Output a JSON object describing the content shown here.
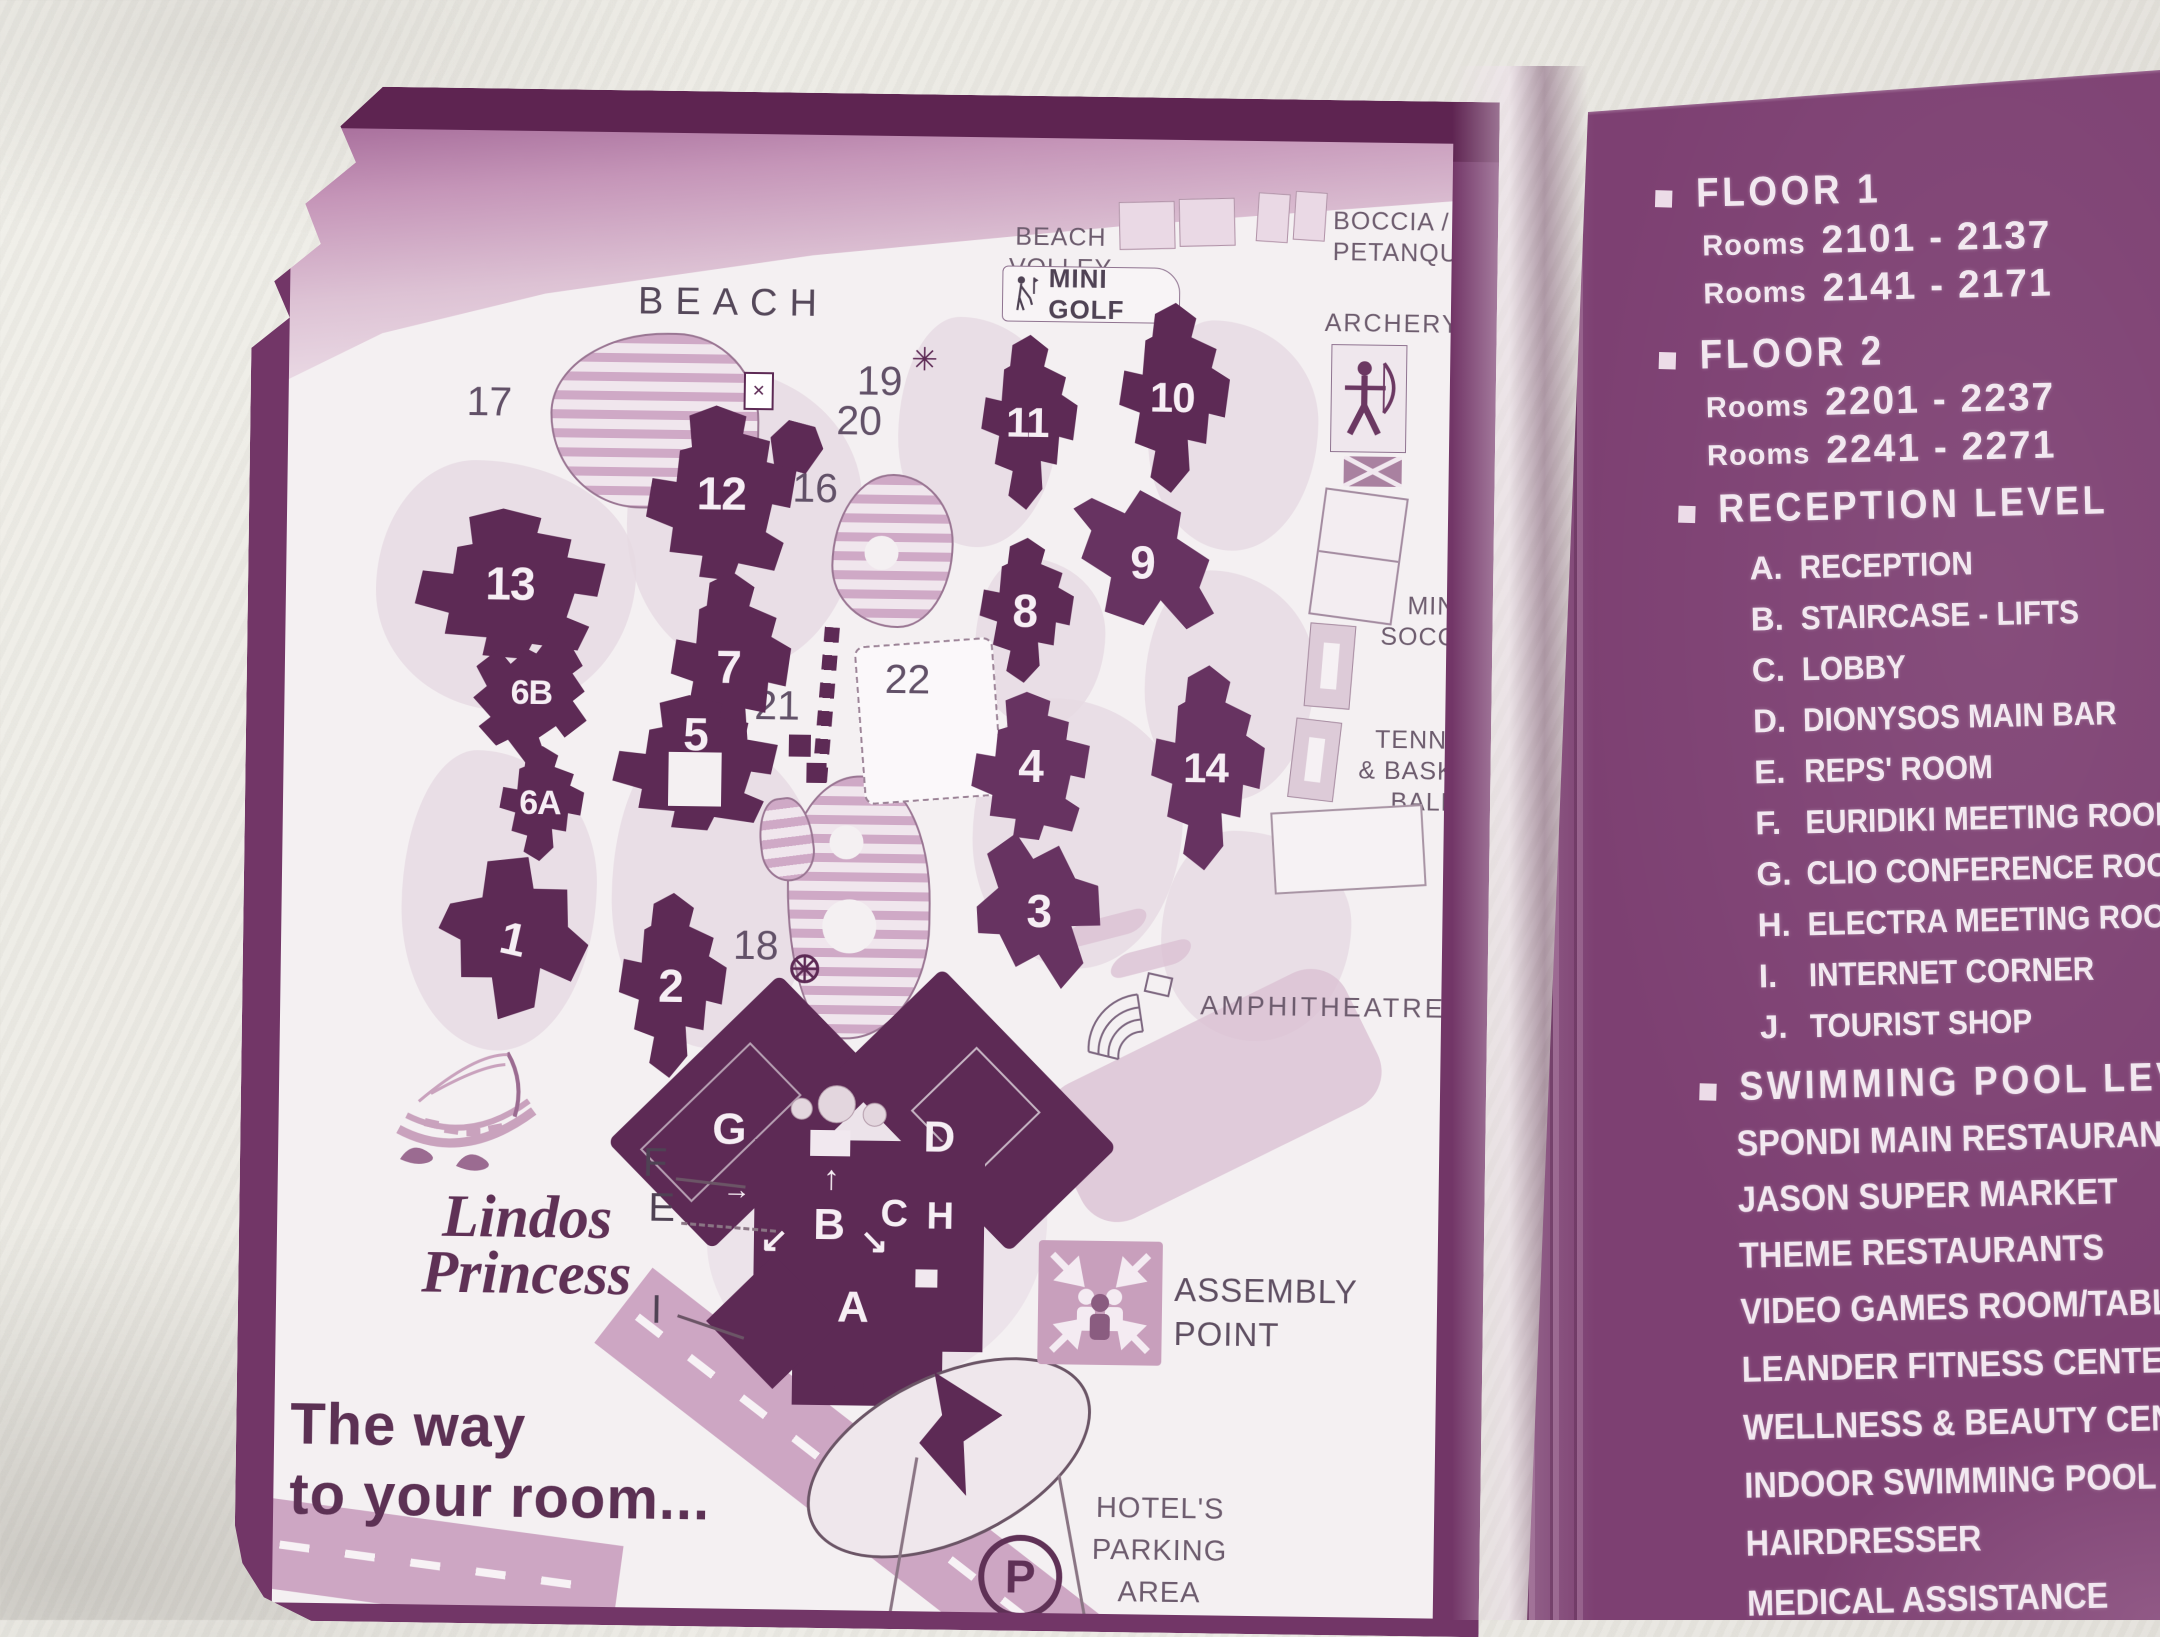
{
  "brand": {
    "name_line1": "Lindos",
    "name_line2": "Princess",
    "tagline_line1": "The way",
    "tagline_line2": "to your room..."
  },
  "map": {
    "beach": "BEACH",
    "beach_volleyball_line1": "BEACH",
    "beach_volleyball_line2": "VOLLEY BALL",
    "mini_golf": "MINI GOLF",
    "boccia_line1": "BOCCIA /",
    "boccia_line2": "PETANQUE",
    "archery": "ARCHERY",
    "mini_soccer_line1": "MINI",
    "mini_soccer_line2": "SOCCER",
    "tennis_line1": "TENNIS",
    "tennis_line2": "& BASKET",
    "tennis_line3": "BALL",
    "amphitheatre": "AMPHITHEATRE",
    "assembly_line1": "ASSEMBLY",
    "assembly_line2": "POINT",
    "parking_line1": "HOTEL'S",
    "parking_line2": "PARKING",
    "parking_line3": "AREA",
    "parking_symbol": "P",
    "cross_mark": "✕",
    "star_mark": "✳",
    "buildings": {
      "b1": "1",
      "b2": "2",
      "b3": "3",
      "b4": "4",
      "b5": "5",
      "b6a": "6A",
      "b6b": "6B",
      "b7": "7",
      "b8": "8",
      "b9": "9",
      "b10": "10",
      "b11": "11",
      "b12": "12",
      "b13": "13",
      "b14": "14"
    },
    "areas": {
      "a15": "15",
      "a16": "16",
      "a17": "17",
      "a18": "18",
      "a19": "19",
      "a20": "20",
      "a21": "21",
      "a22": "22"
    },
    "letters": {
      "A": "A",
      "B": "B",
      "C": "C",
      "D": "D",
      "E": "E",
      "F": "F",
      "G": "G",
      "H": "H",
      "I": "I",
      "J": "J"
    },
    "arrows": {
      "up": "↑",
      "down_left": "↙",
      "down_right": "↘",
      "right": "→"
    }
  },
  "panel": {
    "floor1_title": "FLOOR 1",
    "floor1_rooms": [
      {
        "word": "Rooms",
        "range": "2101 - 2137"
      },
      {
        "word": "Rooms",
        "range": "2141 - 2171"
      }
    ],
    "floor2_title": "FLOOR 2",
    "floor2_rooms": [
      {
        "word": "Rooms",
        "range": "2201 - 2237"
      },
      {
        "word": "Rooms",
        "range": "2241 - 2271"
      }
    ],
    "reception_title": "RECEPTION LEVEL",
    "reception_items": [
      {
        "key": "A.",
        "label": "RECEPTION"
      },
      {
        "key": "B.",
        "label": "STAIRCASE - LIFTS"
      },
      {
        "key": "C.",
        "label": "LOBBY"
      },
      {
        "key": "D.",
        "label": "DIONYSOS MAIN BAR"
      },
      {
        "key": "E.",
        "label": "REPS' ROOM"
      },
      {
        "key": "F.",
        "label": "EURIDIKI MEETING ROOM"
      },
      {
        "key": "G.",
        "label": "CLIO CONFERENCE ROOM"
      },
      {
        "key": "H.",
        "label": "ELECTRA MEETING ROOM"
      },
      {
        "key": "I.",
        "label": "INTERNET CORNER"
      },
      {
        "key": "J.",
        "label": "TOURIST SHOP"
      }
    ],
    "pool_title": "SWIMMING POOL LEVEL",
    "pool_items": [
      "SPONDI MAIN RESTAURANT",
      "JASON SUPER MARKET",
      "THEME RESTAURANTS",
      "VIDEO GAMES ROOM/TABLE TENNIS",
      "LEANDER FITNESS CENTER",
      "WELLNESS & BEAUTY CENTER",
      "INDOOR SWIMMING POOL",
      "HAIRDRESSER",
      "MEDICAL ASSISTANCE"
    ]
  },
  "colors": {
    "card_border": "#723667",
    "page": "#f4f0f2",
    "building": "#5d2a55",
    "panel": "#7d4072",
    "road": "#cda6c3",
    "beach_band": "#b97fa9",
    "panel_text": "#f2e8f0",
    "map_text": "#5b4a5e"
  }
}
